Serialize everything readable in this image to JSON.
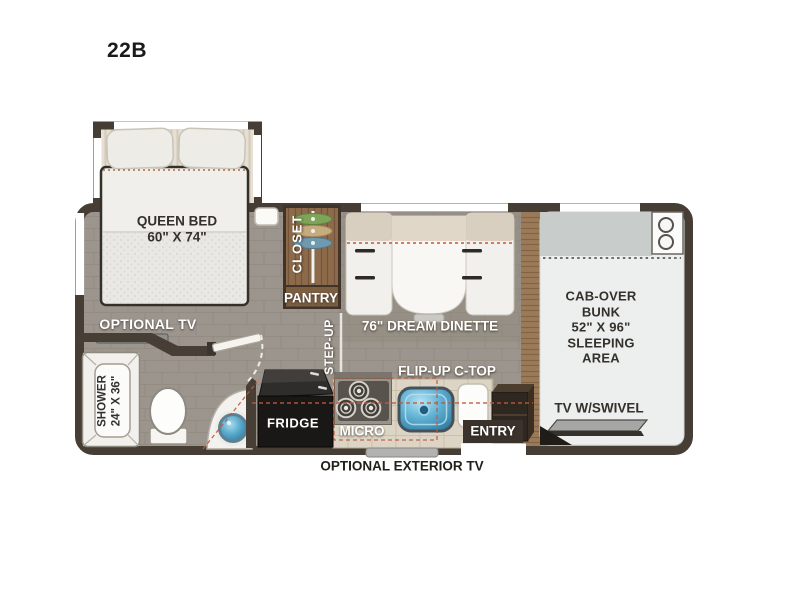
{
  "model": "22B",
  "labels": {
    "queen_bed_line1": "QUEEN BED",
    "queen_bed_line2": "60\" X 74\"",
    "optional_tv": "OPTIONAL TV",
    "closet": "CLOSET",
    "pantry": "PANTRY",
    "step_up": "STEP-UP",
    "dinette": "76\" DREAM DINETTE",
    "cab_over_line1": "CAB-OVER",
    "cab_over_line2": "BUNK",
    "cab_over_line3": "52\" X 96\"",
    "cab_over_line4": "SLEEPING",
    "cab_over_line5": "AREA",
    "tv_swivel": "TV W/SWIVEL",
    "flip_up_ctop": "FLIP-UP C-TOP",
    "fridge": "FRIDGE",
    "micro": "MICRO",
    "entry": "ENTRY",
    "shower_line1": "SHOWER",
    "shower_line2": "24\" X 36\"",
    "optional_exterior_tv": "OPTIONAL EXTERIOR TV"
  },
  "colors": {
    "wall": "#463d35",
    "floor": "#9c958d",
    "closet_wood": "#8d6a49",
    "counter": "#dcd4c4",
    "sink_blue": "#58aed2",
    "option_dashed": "#c0593a",
    "fridge_black": "#191817",
    "cab_area": "#edefee"
  }
}
